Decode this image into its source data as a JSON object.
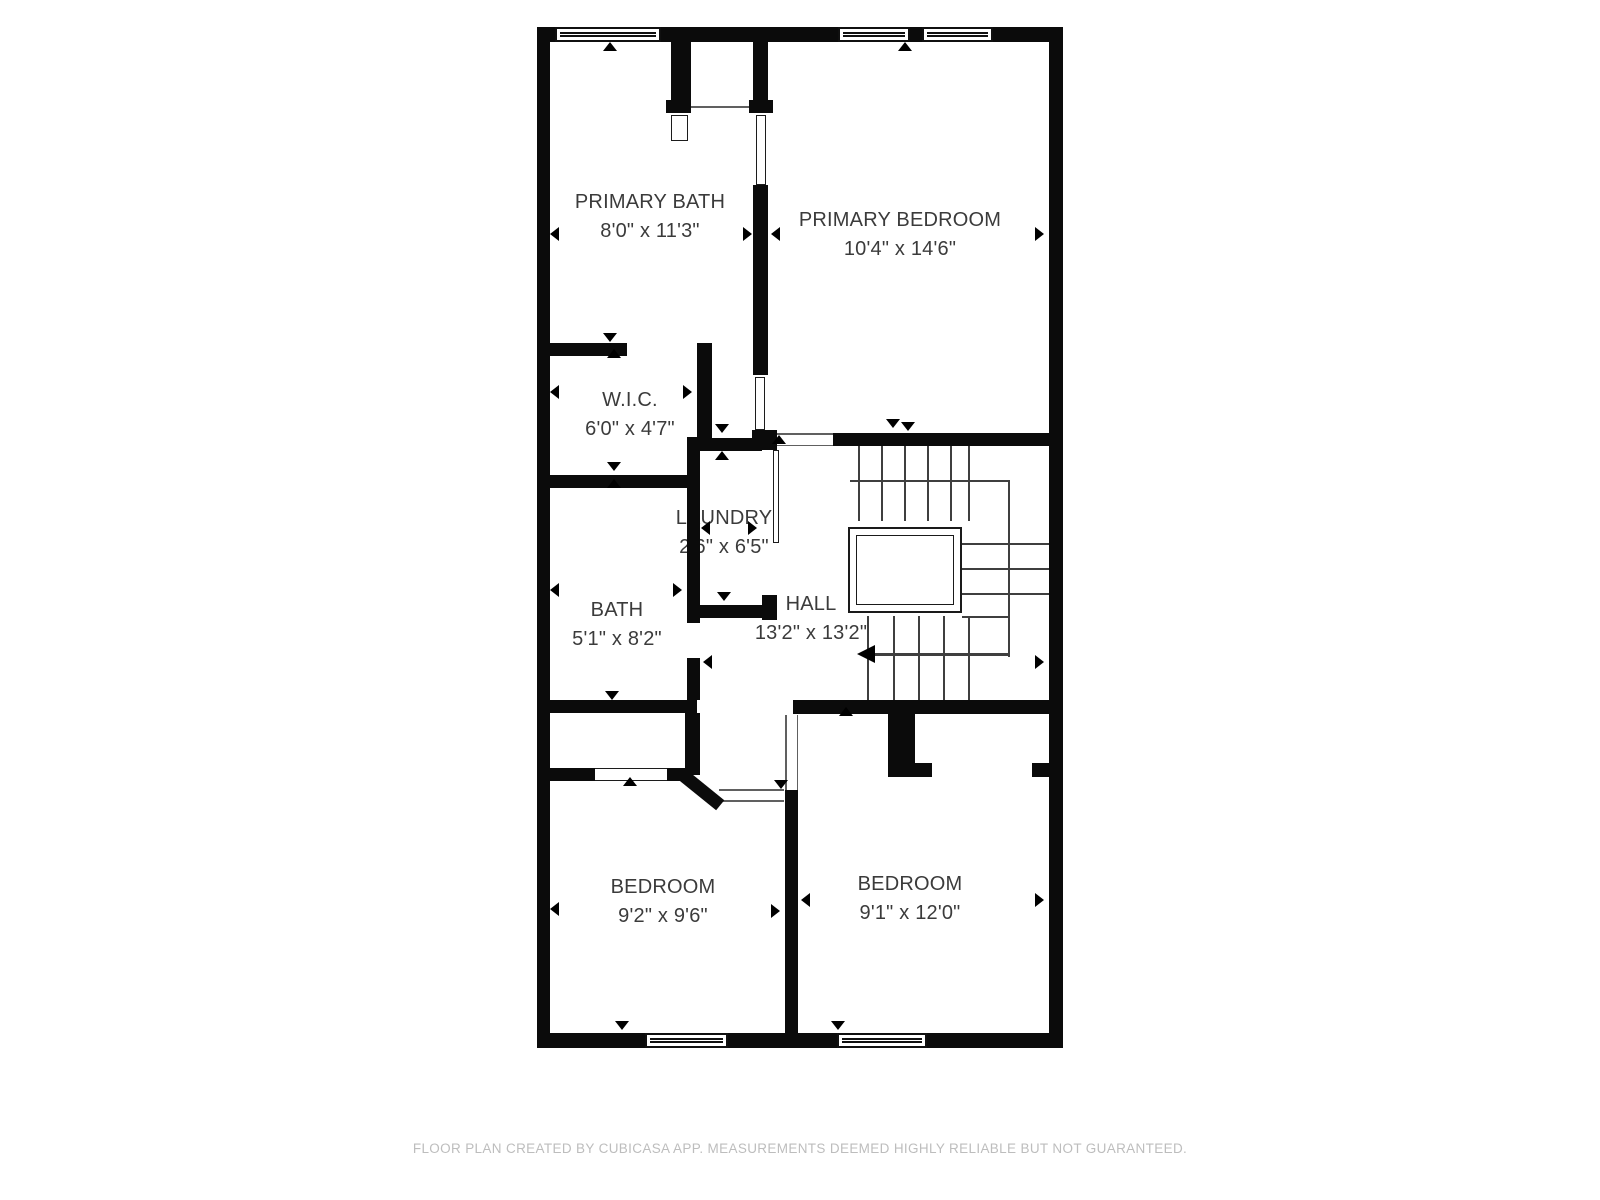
{
  "plan": {
    "rooms": [
      {
        "id": "primary-bath",
        "name": "PRIMARY BATH",
        "dims": "8'0\" x 11'3\""
      },
      {
        "id": "primary-bedroom",
        "name": "PRIMARY BEDROOM",
        "dims": "10'4\" x 14'6\""
      },
      {
        "id": "wic",
        "name": "W.I.C.",
        "dims": "6'0\" x 4'7\""
      },
      {
        "id": "laundry",
        "name": "LAUNDRY",
        "dims": "2'6\" x 6'5\""
      },
      {
        "id": "bath",
        "name": "BATH",
        "dims": "5'1\" x 8'2\""
      },
      {
        "id": "hall",
        "name": "HALL",
        "dims": "13'2\" x 13'2\""
      },
      {
        "id": "bedroom-left",
        "name": "BEDROOM",
        "dims": "9'2\" x 9'6\""
      },
      {
        "id": "bedroom-right",
        "name": "BEDROOM",
        "dims": "9'1\" x 12'0\""
      }
    ],
    "features": [
      "staircase-with-central-void",
      "stair-direction-arrow-left",
      "windows-top:2",
      "windows-bottom:2"
    ],
    "colors": {
      "wall": "#0b0b0b",
      "label": "#3b3b3b",
      "footer": "#bdbdbd",
      "background": "#ffffff"
    }
  },
  "footer": {
    "text": "FLOOR PLAN CREATED BY CUBICASA APP. MEASUREMENTS DEEMED HIGHLY RELIABLE BUT NOT GUARANTEED."
  }
}
